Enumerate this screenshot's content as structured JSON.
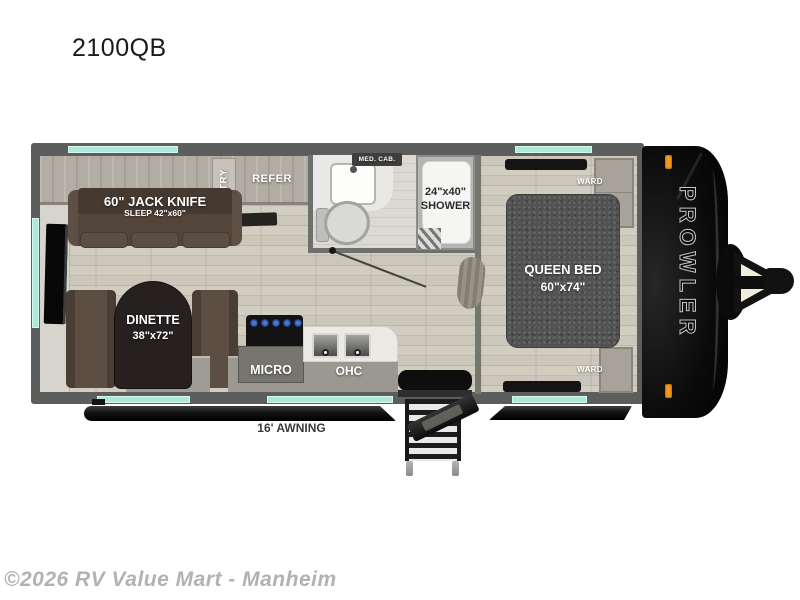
{
  "page": {
    "title": "2100QB",
    "watermark": "©2026 RV Value Mart - Manheim"
  },
  "floorplan": {
    "brand_vertical": "PROWLER",
    "awning_label": "16' AWNING",
    "kitchen": {
      "pantry_label": "PANTRY",
      "refer_label": "REFER",
      "micro_label": "MICRO",
      "ohc_left_label": "OHC",
      "ohc_right_label": "OHC"
    },
    "living": {
      "sofa_title": "60\" JACK KNIFE",
      "sofa_subtitle": "SLEEP 42\"x60\"",
      "dinette_title": "DINETTE",
      "dinette_size": "38\"x72\""
    },
    "bathroom": {
      "med_cab_label": "MED. CAB.",
      "shower_size": "24\"x40\"",
      "shower_label": "SHOWER"
    },
    "bedroom": {
      "bed_title": "QUEEN BED",
      "bed_size": "60\"x74\"",
      "ward_top_label": "WARD",
      "ward_bottom_label": "WARD"
    },
    "colors": {
      "window_teal": "#a9ead9",
      "wall_gray": "#5c5e5d",
      "cap_black": "#0b0b0b",
      "marker_orange": "#f59a1e",
      "floor_beige": "#c9c4b8",
      "cabinet_taupe": "#b2ada3",
      "sofa_brown": "#54453b",
      "bed_gray": "#525252",
      "table_brown": "#262120",
      "counter_white": "#eceae5"
    }
  }
}
